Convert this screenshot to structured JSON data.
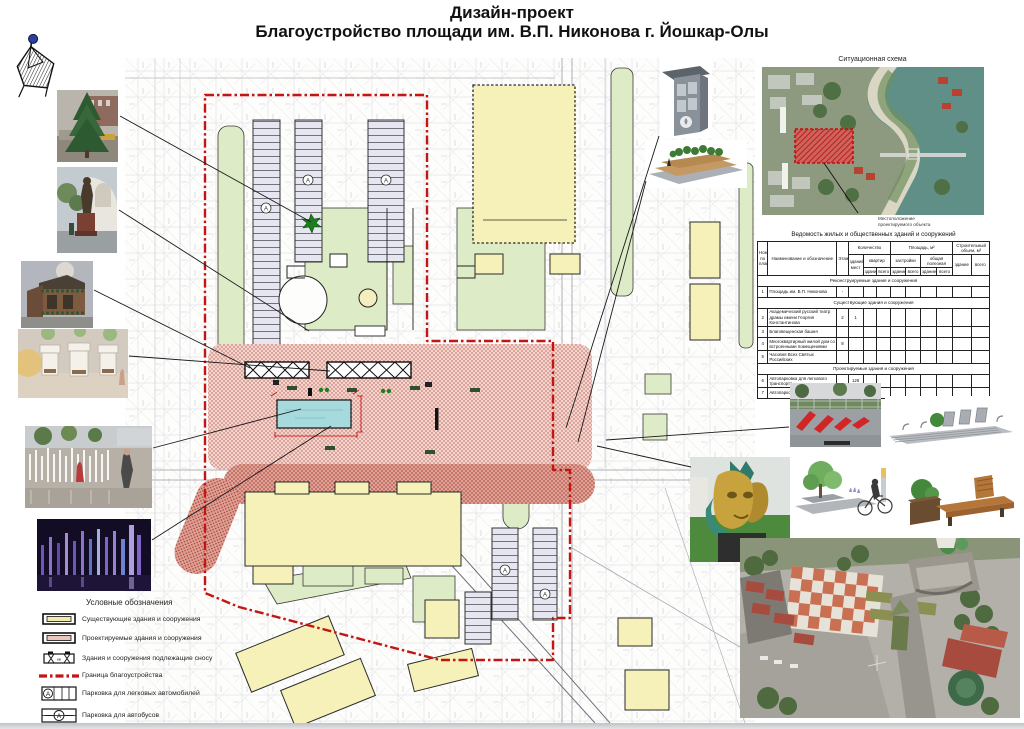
{
  "page": {
    "title_line1": "Дизайн-проект",
    "title_line2": "Благоустройство площади им. В.П. Никонова г. Йошкар-Олы"
  },
  "situational_scheme": {
    "title": "Ситуационная схема",
    "caption_line1": "Местоположение",
    "caption_line2": "проектируемого объекта"
  },
  "legend": {
    "title": "Условные обозначения",
    "items": [
      {
        "symbol": "existing-building-swatch",
        "label": "Существующие здания и сооружения"
      },
      {
        "symbol": "planned-building-swatch",
        "label": "Проектируемые здания и сооружения"
      },
      {
        "symbol": "demolition-building-swatch",
        "label": "Здания и сооружения подлежащие сносу"
      },
      {
        "symbol": "boundary-line-swatch",
        "label": "Граница благоустройства"
      },
      {
        "symbol": "car-parking-symbol",
        "label": "Парковка для легковых автомобилей"
      },
      {
        "symbol": "bus-parking-symbol",
        "label": "Парковка для автобусов"
      }
    ]
  },
  "table": {
    "title": "Ведомость жилых и общественных зданий и сооружений",
    "columns": {
      "num": "Номер по плану",
      "name": "Наименование и обозначение",
      "floors": "Этажность",
      "qty_group": "Количество",
      "qty_places": "зданий, мест",
      "qty_flats": "квартир",
      "area_group": "Площадь, м²",
      "area_built": "застройки",
      "area_total": "общая полезная",
      "volume_group": "Строительный объем, м³",
      "sub_building": "здание",
      "sub_total": "всего"
    },
    "sections": [
      {
        "header": "Реконструируемые здания и сооружения",
        "rows": [
          {
            "num": "1",
            "name": "Площадь им. В.П. Никонова",
            "cells": [
              "-",
              "",
              "",
              "",
              "",
              "",
              "",
              "",
              "",
              ""
            ]
          }
        ]
      },
      {
        "header": "Существующие здания и сооружения",
        "rows": [
          {
            "num": "2",
            "name": "Академический русский театр драмы имени Георгия Константинова",
            "cells": [
              "2",
              "1",
              "",
              "",
              "",
              "",
              "",
              "",
              "",
              ""
            ]
          },
          {
            "num": "3",
            "name": "Благовещенская башня",
            "cells": [
              "",
              "",
              "",
              "",
              "",
              "",
              "",
              "",
              "",
              ""
            ]
          },
          {
            "num": "4",
            "name": "Многоквартирный жилой дом со встроенными помещениями",
            "cells": [
              "8",
              "",
              "",
              "",
              "",
              "",
              "",
              "",
              "",
              ""
            ]
          },
          {
            "num": "5",
            "name": "Часовня Всех Святых Российских",
            "cells": [
              "",
              "",
              "",
              "",
              "",
              "",
              "",
              "",
              "",
              ""
            ]
          }
        ]
      },
      {
        "header": "Проектируемые здания и сооружения",
        "rows": [
          {
            "num": "6",
            "name": "Автопарковка для легкового транспорта",
            "cells": [
              "",
              "128",
              "",
              "",
              "",
              "",
              "",
              "",
              "",
              ""
            ]
          },
          {
            "num": "7",
            "name": "Автопарковка для автобусов",
            "cells": [
              "",
              "10",
              "",
              "",
              "",
              "",
              "",
              "",
              "",
              ""
            ]
          }
        ]
      }
    ]
  },
  "icons": {
    "north_arrow": "compass-north-arrow"
  },
  "colors": {
    "boundary_red": "#c41414",
    "existing_yellow": "#f5f1b8",
    "planned_pink": "#e9c7bf",
    "green_area": "#ddecc6",
    "plaza_red_stipple": "#d89287",
    "fountain_cyan": "#a6dadc",
    "parking_lavender": "#e6e6f0",
    "site_highlight_red": "#d42020"
  }
}
